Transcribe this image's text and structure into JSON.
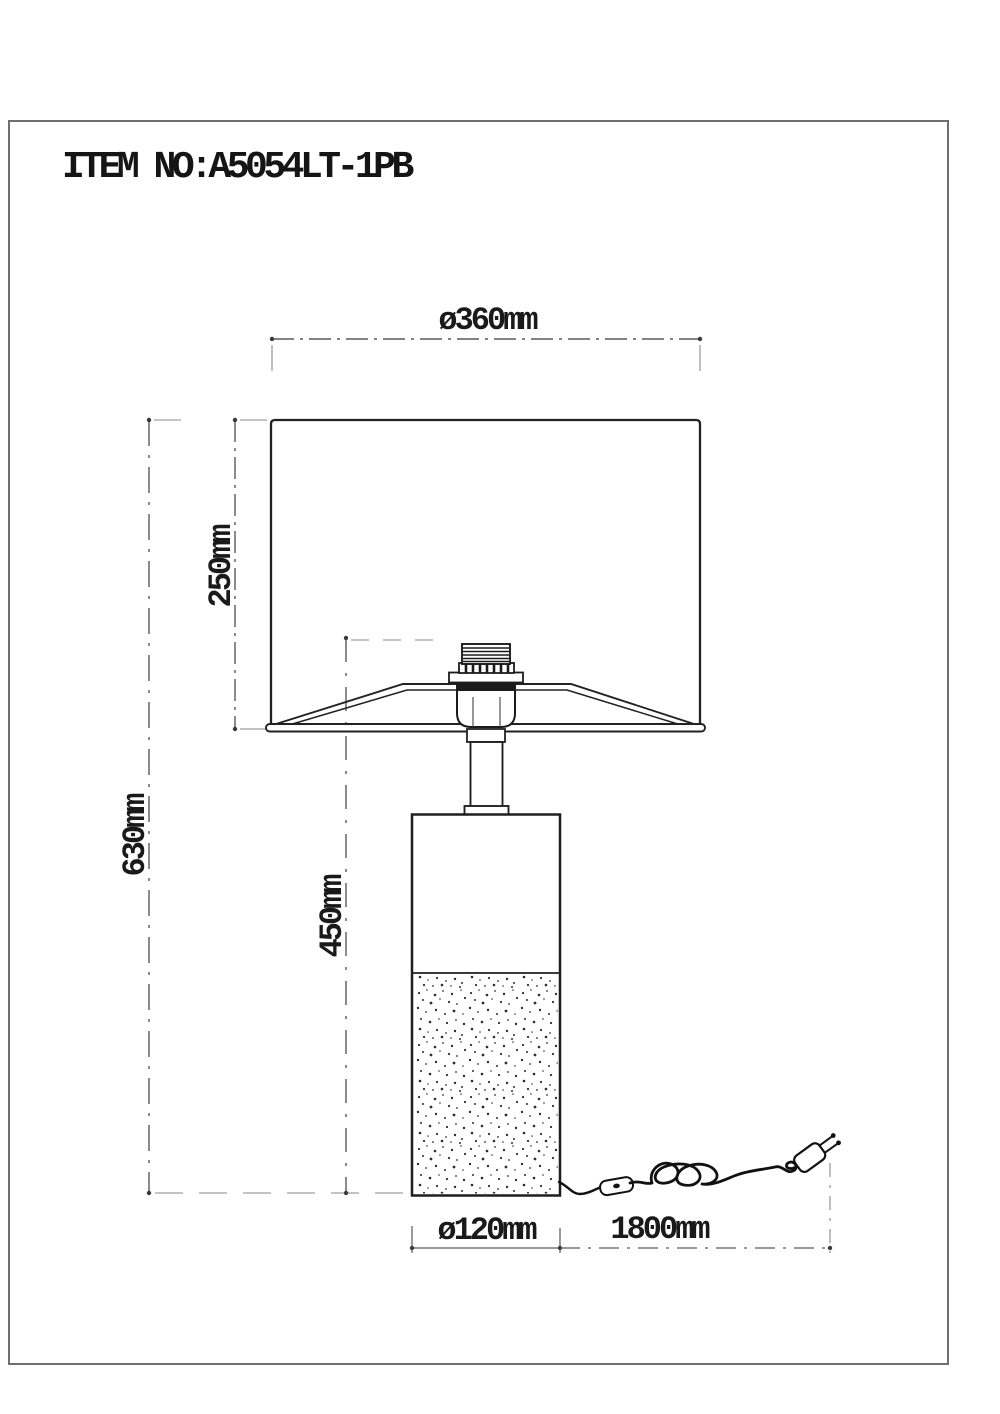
{
  "page": {
    "item_label": "ITEM NO:A5054LT-1PB"
  },
  "drawing": {
    "type": "technical-dimension-diagram",
    "subject": "table lamp with cylindrical base, fabric shade, cord and plug",
    "dimensions": {
      "shade_diameter": "ø360mm",
      "shade_height": "250mm",
      "total_height": "630mm",
      "body_height": "450mm",
      "base_diameter": "ø120mm",
      "cord_length": "1800mm"
    },
    "colors": {
      "outline": "#1b1b1b",
      "dimension_line": "#5a5a5a",
      "extension_line": "#8a8a8a",
      "border": "#6f6f6f",
      "background": "#ffffff"
    }
  }
}
